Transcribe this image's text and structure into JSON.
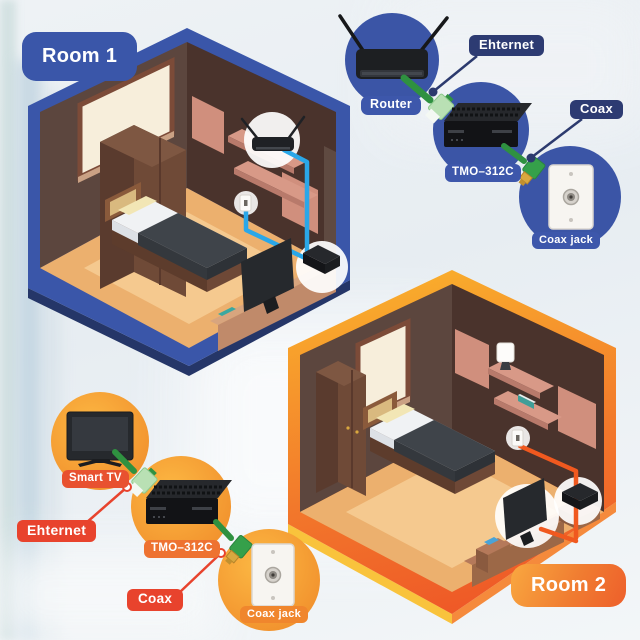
{
  "room1": {
    "label": "Room 1"
  },
  "room2": {
    "label": "Room 2"
  },
  "top_diagram": {
    "router": "Router",
    "ethernet": "Ehternet",
    "adapter": "TMO–312C",
    "coax": "Coax",
    "coax_jack": "Coax jack"
  },
  "bottom_diagram": {
    "smart_tv": "Smart TV",
    "ethernet": "Ehternet",
    "adapter": "TMO–312C",
    "coax": "Coax",
    "coax_jack": "Coax jack"
  },
  "icons": {
    "router": "router-icon",
    "smart_tv": "smart-tv-icon",
    "moca_adapter": "moca-adapter-icon",
    "coax_wall_plate": "coax-wall-plate-icon",
    "ethernet_cable": "ethernet-cable-icon",
    "coax_cable": "coax-cable-icon",
    "wall_jack": "wall-jack-icon"
  },
  "colors": {
    "room1_accent": "#3a56a9",
    "room2_accent_top": "#f9ab2c",
    "room2_accent_bottom": "#ee5426",
    "navy_label": "#2d3b72",
    "blue_label": "#3d57ab",
    "red_label": "#e8432d",
    "cable_blue": "#2aa7e8",
    "cable_orange": "#f0591f",
    "cable_green": "#2f9140"
  }
}
